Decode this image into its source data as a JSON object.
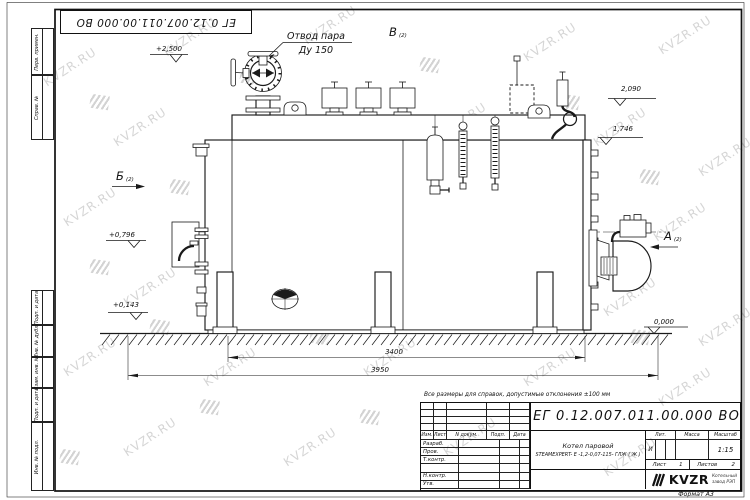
{
  "sheet": {
    "watermark_text": "KVZR.RU",
    "format_label": "Формат А3"
  },
  "top_stamp": {
    "doc_number": "ЕГ 0.12.007.011.00.000  ВО"
  },
  "margin": {
    "labels": [
      "Перв. примен.",
      "Справ. №",
      "Подп. и дата",
      "Инв. № дубл.",
      "Взам. инв. №",
      "Подп. и дата",
      "Инв. № подл."
    ]
  },
  "drawing": {
    "callout_steam_line1": "Отвод пара",
    "callout_steam_line2": "Ду 150",
    "views": {
      "top": {
        "letter": "В",
        "sub": "(2)"
      },
      "left": {
        "letter": "Б",
        "sub": "(2)"
      },
      "right": {
        "letter": "А",
        "sub": "(2)"
      }
    },
    "levels": {
      "l2500": "+2,500",
      "l2090": "2,090",
      "l1746": "1,746",
      "l0796": "+0,796",
      "l0143": "+0,143",
      "l0000": "0,000"
    },
    "dims": {
      "d3400": "3400",
      "d3950": "3950"
    }
  },
  "note": "Все размеры для справок, допустимые отклонения ±100 мм",
  "title_block": {
    "doc_number": "ЕГ 0.12.007.011.00.000  ВО",
    "rev_cols": [
      "Изм.",
      "Лист",
      "N докум.",
      "Подп.",
      "Дата"
    ],
    "roles": [
      "Разраб.",
      "Пров.",
      "Т.контр.",
      "",
      "Н.контр.",
      "Утв."
    ],
    "name_line1": "Котел паровой",
    "name_line2": "STEAMEXPERT- Е -1,2-0,07-115- ГЛЖ ( Ж )",
    "lit_label": "Лит.",
    "lit_value": "И",
    "mass_label": "Масса",
    "scale_label": "Масштаб",
    "scale_value": "1:15",
    "sheet_label": "Лист",
    "sheet_no": "1",
    "sheets_label": "Листов",
    "sheets_total": "2",
    "brand": "KVZR",
    "brand_line1": "Котельный",
    "brand_line2": "завод РЭП"
  }
}
